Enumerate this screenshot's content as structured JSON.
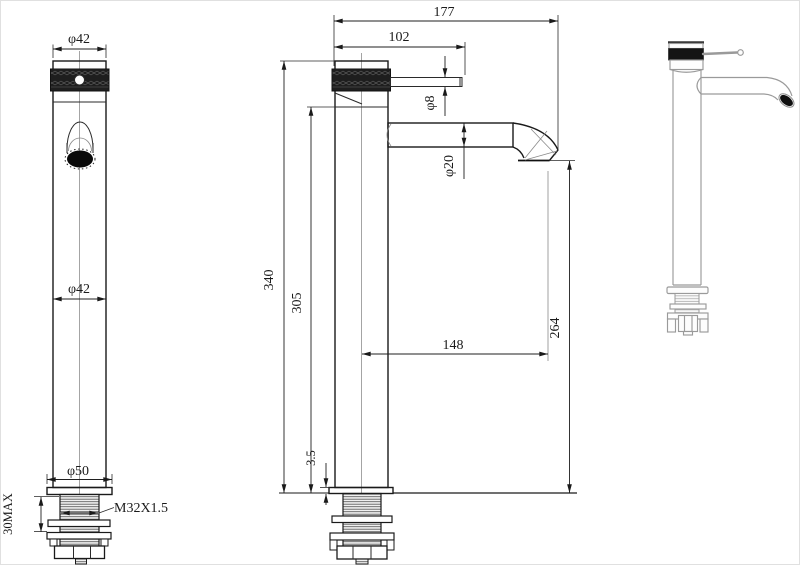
{
  "page": {
    "background": "#ffffff",
    "ink_color": "#1a1a1a",
    "centerline_color": "#9b9b9b",
    "render_line_color": "#9a9a9a"
  },
  "views": {
    "front": {
      "name": "front-orthographic-view",
      "dim_top_diameter": "φ42",
      "dim_body_diameter": "φ42",
      "dim_base_diameter": "φ50",
      "dim_thread_spec": "M32X1.5",
      "dim_mount_depth": "30MAX"
    },
    "side": {
      "name": "side-orthographic-view",
      "dim_overall_reach": "177",
      "dim_handle_reach": "102",
      "dim_rod_diameter": "φ8",
      "dim_spout_diameter": "φ20",
      "dim_overall_height": "340",
      "dim_shoulder_height": "305",
      "dim_spout_reach": "148",
      "dim_outlet_height": "264",
      "dim_plate_thickness": "3.5"
    },
    "iso": {
      "name": "shaded-render-view"
    }
  }
}
